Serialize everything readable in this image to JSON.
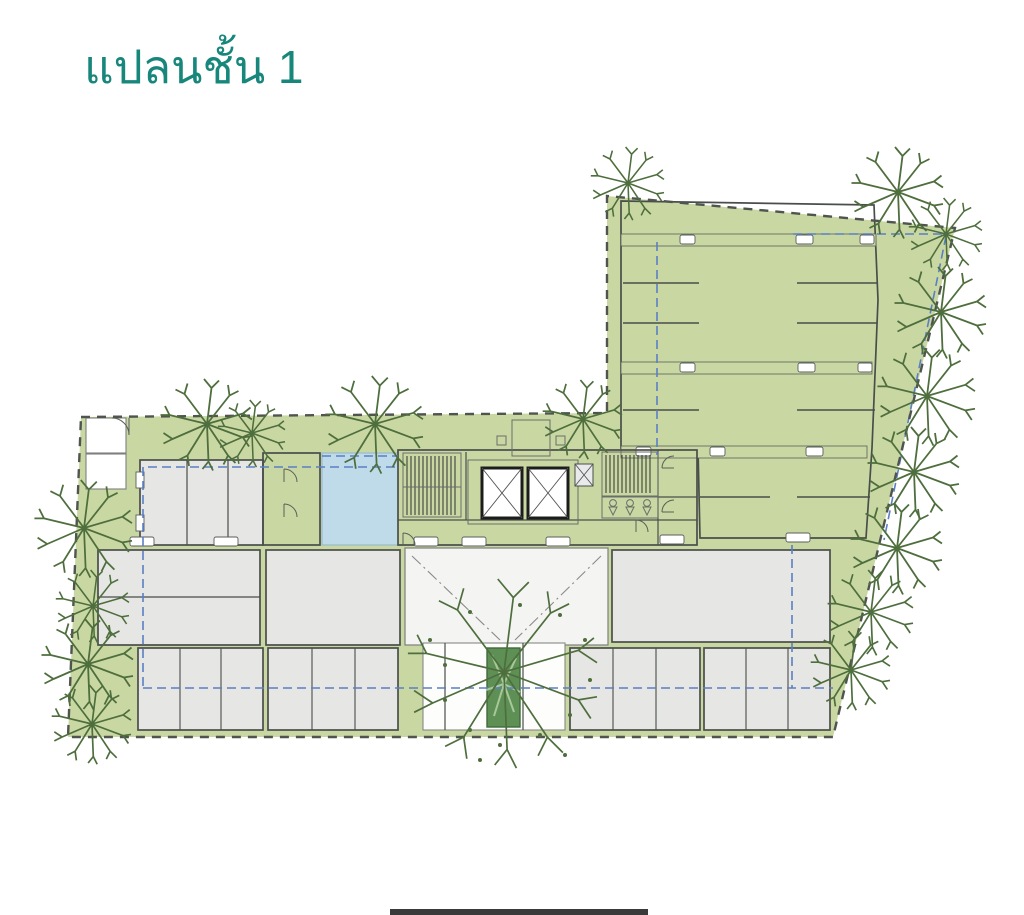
{
  "title": {
    "text": "แปลนชั้น 1"
  },
  "colors": {
    "title-teal": "#17867b",
    "landscape-green": "#c9d8a3",
    "tree-green": "#4e6e3d",
    "planter-green": "#5e9055",
    "paving-gray": "#e6e6e4",
    "room-white": "#fdfdfc",
    "utility-gray": "#b9bdbf",
    "pool-blue": "#bfdbea",
    "boundary-dark": "#4f544f",
    "setback-blue": "#5b7fc4",
    "wall-dark": "#4a4e4a"
  }
}
